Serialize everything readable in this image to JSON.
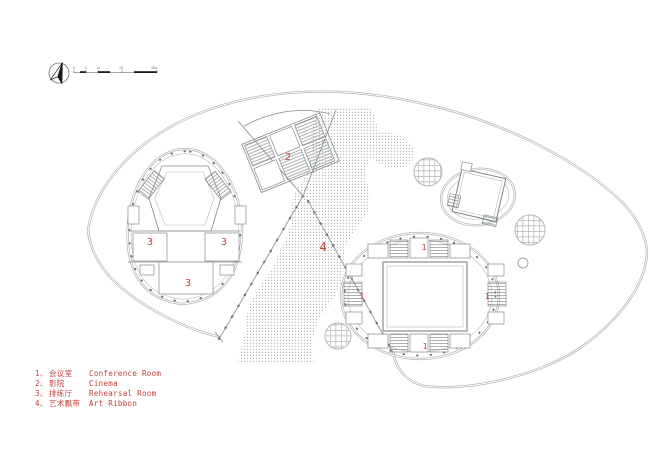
{
  "legend": {
    "items": [
      {
        "no": "1、",
        "zh": "会议室",
        "en": "Conference Room"
      },
      {
        "no": "2、",
        "zh": "影院",
        "en": "Cinema"
      },
      {
        "no": "3、",
        "zh": "排练厅",
        "en": "Rehearsal Room"
      },
      {
        "no": "4、",
        "zh": "艺术飘带",
        "en": "Art Ribbon"
      }
    ]
  },
  "plan_labels": {
    "conference_top": "1",
    "conference_left": "1",
    "conference_right": "1",
    "conference_bottom": "1",
    "cinema": "2",
    "rehearsal_left": "3",
    "rehearsal_right": "3",
    "rehearsal_bottom": "3",
    "art_ribbon": "4"
  },
  "scale_bar": {
    "labels": [
      "0",
      "5",
      "10",
      "20",
      "50m"
    ]
  },
  "colors": {
    "label_red": "#c73e36",
    "wall_gray": "#a6aaad",
    "line_gray": "#9aa0a3",
    "detail_gray": "#868b8e",
    "dot_gray": "#a9adb0"
  }
}
